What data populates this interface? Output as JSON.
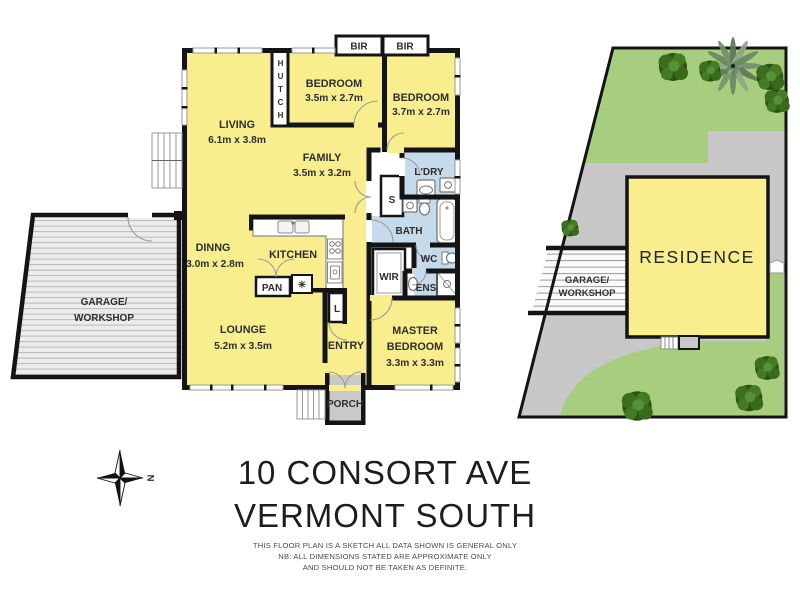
{
  "title": {
    "line1": "10 CONSORT AVE",
    "line2": "VERMONT SOUTH"
  },
  "disclaimer": {
    "line1": "THIS FLOOR PLAN IS A SKETCH ALL DATA SHOWN IS GENERAL ONLY",
    "line2": "NB: ALL DIMENSIONS STATED ARE APPROXIMATE ONLY",
    "line3": "AND SHOULD NOT BE TAKEN AS DEFINITE."
  },
  "compass": {
    "north": "N"
  },
  "floorplan": {
    "living": {
      "name": "LIVING",
      "dims": "6.1m x 3.8m"
    },
    "family": {
      "name": "FAMILY",
      "dims": "3.5m x 3.2m"
    },
    "bedroom1": {
      "name": "BEDROOM",
      "dims": "3.5m x 2.7m"
    },
    "bedroom2": {
      "name": "BEDROOM",
      "dims": "3.7m x 2.7m"
    },
    "dining": {
      "name": "DINNG",
      "dims": "3.0m x 2.8m"
    },
    "lounge": {
      "name": "LOUNGE",
      "dims": "5.2m x 3.5m"
    },
    "master": {
      "name_line1": "MASTER",
      "name_line2": "BEDROOM",
      "dims": "3.3m x 3.3m"
    },
    "kitchen": {
      "name": "KITCHEN"
    },
    "entry": {
      "name": "ENTRY"
    },
    "porch": {
      "name": "PORCH"
    },
    "garage": {
      "line1": "GARAGE/",
      "line2": "WORKSHOP"
    },
    "bir1": "BIR",
    "bir2": "BIR",
    "hutch": [
      "H",
      "U",
      "T",
      "C",
      "H"
    ],
    "ldry": "L'DRY",
    "bath": "BATH",
    "wc": "WC",
    "ens": "ENS",
    "wir": "WIR",
    "store": "S",
    "pan": "PAN",
    "linen": "L",
    "dishwasher": "✳"
  },
  "siteplan": {
    "residence": "RESIDENCE",
    "garage": {
      "line1": "GARAGE/",
      "line2": "WORKSHOP"
    }
  },
  "colors": {
    "room_yellow": "#F8EE8E",
    "wet_blue": "#C5DAEB",
    "wall_black": "#141414",
    "porch_gray": "#C9C9C9",
    "lawn_green": "#A7CE7E",
    "driveway_gray": "#C8C8C8",
    "deck_gray": "#ECECEC",
    "tree_green": "#2C5316"
  }
}
